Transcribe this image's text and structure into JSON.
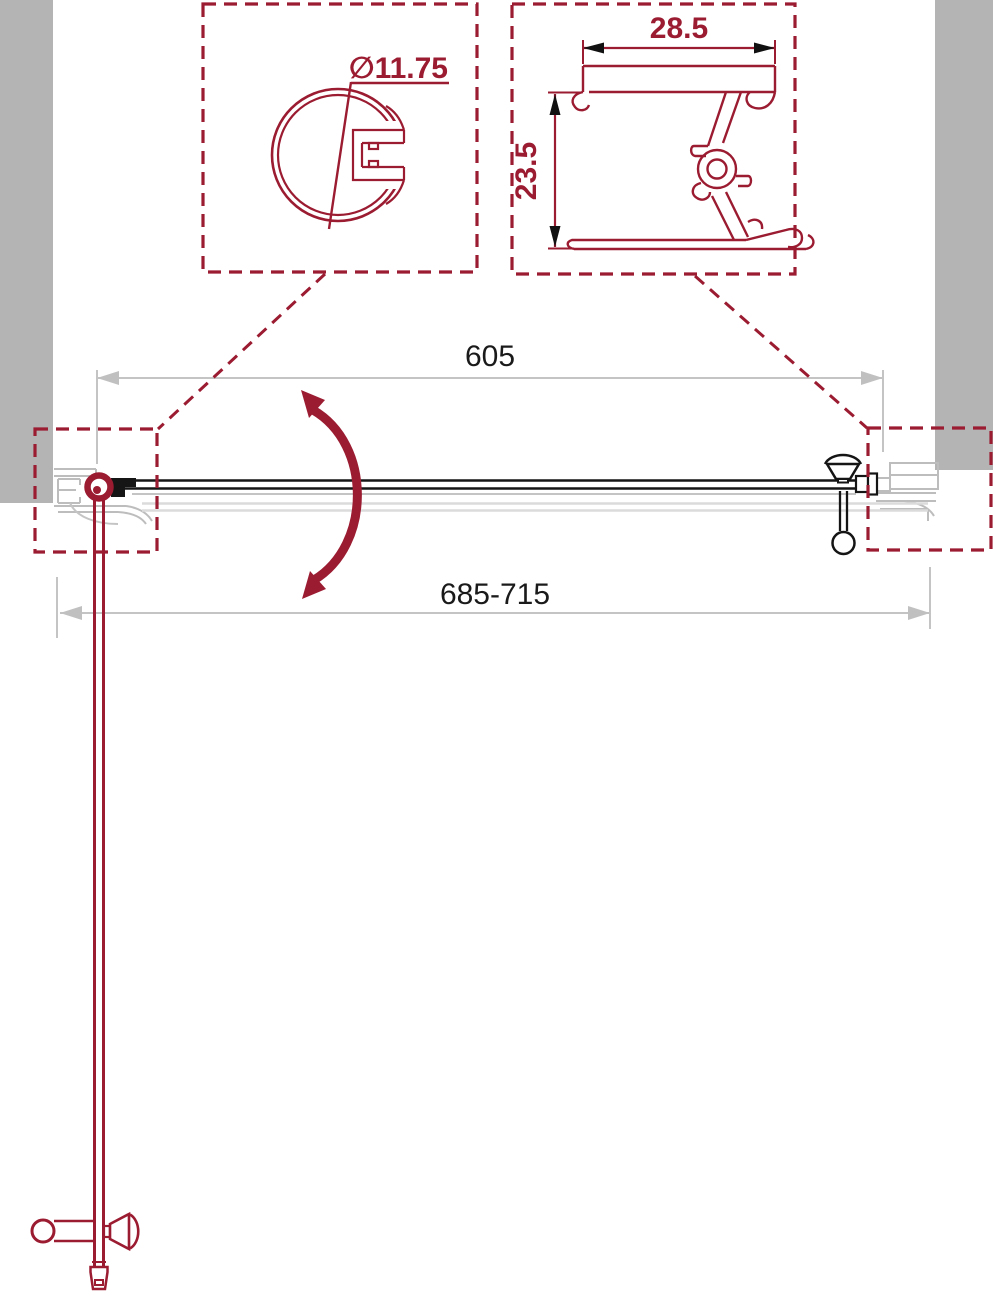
{
  "page": {
    "type": "technical-drawing",
    "subject": "Pivot shower door installation drawing, top view with profile details",
    "background": "#ffffff"
  },
  "labels": {
    "door_width": "605",
    "overall_width": "685-715",
    "profile_diameter": "∅11.75",
    "wall_profile_width": "28.5",
    "wall_profile_depth": "23.5"
  },
  "colors": {
    "accent_red": "#9B1B31",
    "wall_gray": "#B4B4B4",
    "profile_gray": "#BDBDBD",
    "dimension_gray": "#C4C4C4",
    "ghost_gray": "#DBDBDB",
    "drawing_black": "#151515",
    "dim_text_black": "#1A1A1A"
  }
}
